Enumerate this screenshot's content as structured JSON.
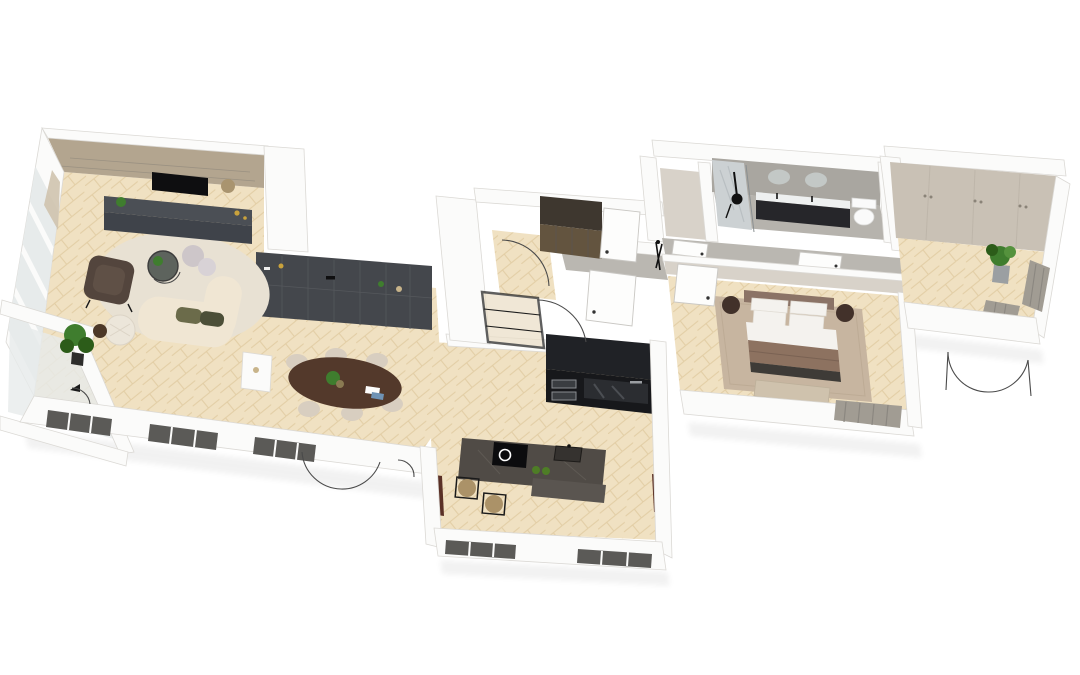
{
  "scene": {
    "title": "3D dollhouse floor plan render of an apartment, top-down angled view on white background",
    "view": "top-down 3d dollhouse",
    "door_swing_arcs_visible": 7,
    "rooms": [
      {
        "name": "living-room",
        "floor": "light herringbone wood",
        "contents": [
          "wall-mounted tv",
          "dark tv console",
          "textured beige accent wall",
          "curved cream sofa with olive cushions",
          "brown leather armchair",
          "round glass coffee table with plant",
          "round cream rug",
          "knit pouf",
          "corner floor plant",
          "tall curtained windows",
          "balcony with white railing and plant"
        ]
      },
      {
        "name": "dining-area",
        "floor": "light herringbone wood",
        "contents": [
          "dark charcoal wall shelving unit with decor",
          "oval walnut dining table",
          "six beige chairs",
          "table plant and magazines",
          "small white side shelf",
          "french doors with swing arcs"
        ]
      },
      {
        "name": "kitchen",
        "floor": "light herringbone wood",
        "contents": [
          "black tall cabinet wall with double ovens",
          "dark stone island",
          "induction cooktop",
          "island sink",
          "green apples",
          "two rattan bar stools",
          "dark window strips in bottom wall",
          "brown side panels"
        ]
      },
      {
        "name": "entry-hall",
        "floor": "light herringbone wood",
        "contents": [
          "dark wood wardrobe",
          "two white doors with handles",
          "black steel-framed glass partition",
          "door swing arc"
        ]
      },
      {
        "name": "hallway",
        "floor": "grey screed",
        "contents": [
          "white door leafs",
          "black coat rack"
        ]
      },
      {
        "name": "bathroom",
        "floor": "grey concrete",
        "contents": [
          "marble shower wall with black shower set",
          "dark double vanity with white top",
          "two round mirrors",
          "toilet",
          "adjoining small closet room"
        ]
      },
      {
        "name": "bedroom",
        "floor": "light herringbone wood",
        "contents": [
          "double bed with white pillows and taupe blanket",
          "dark throw",
          "foot bench",
          "two round dark nightstands",
          "large beige area rug",
          "white door leaf",
          "curtained bottom window"
        ]
      },
      {
        "name": "second-room",
        "floor": "light herringbone wood",
        "contents": [
          "built-in beige wardrobe wall with handles",
          "potted plant",
          "curtained right windows",
          "french doors with swing arcs"
        ]
      }
    ]
  },
  "palette": {
    "bg": "#ffffff",
    "wallTop": "#fbfbfa",
    "wallFace": "#f1f0ee",
    "wallEdge": "#dbd9d5",
    "wallBeige": "#d8d2c9",
    "accentWall": "#b3a58f",
    "woodBase": "#f0e1c2",
    "woodLine": "#e2cda4",
    "concreteWall": "#a9a6a0",
    "concreteFloor": "#b6b3ad",
    "hallFloor": "#bab7b1",
    "shelfDark": "#44474c",
    "shelfDarker": "#393c41",
    "consoleDark": "#4b4f55",
    "consoleFace": "#3f434a",
    "tvBlack": "#0e0e10",
    "kitchenTall": "#202226",
    "kitchenTallFace": "#17181b",
    "island": "#504b46",
    "islandLower": "#5a5550",
    "cooktop": "#0c0c0e",
    "sofa": "#f0e6d3",
    "rugLiving": "#e8e1d3",
    "armchair": "#53453d",
    "armchairSeat": "#5f5046",
    "pouf": "#cdc6c9",
    "knitPouf": "#ece6da",
    "tableWood": "#53392b",
    "chair": "#d8cec0",
    "bedHead": "#8b7366",
    "bedSheet": "#f4f2ee",
    "bedBlanket": "#8d7260",
    "bedThrow": "#3e3b37",
    "bedBench": "#cfc2ad",
    "rugBedroom": "#c7b5a0",
    "nightstand": "#42312a",
    "plantGreen": "#3f7d2e",
    "plantDark": "#2c5c19",
    "potGray": "#9b9fa2",
    "marble": "#ccd1d3",
    "vanityDark": "#26262a",
    "vanityTop": "#eef0f0",
    "mirror": "#c3c8c6",
    "toiletWhite": "#fafafa",
    "curtain": "#a19c93",
    "curtainBeige": "#cfc3ae",
    "maroonPanel": "#5a3026",
    "windowDark": "#5b5a57",
    "glassPane": "#e7ebeb",
    "arcStroke": "#4a4a4a",
    "doorLeaf": "#fdfdfc",
    "doorLeafStroke": "#c9c7c3",
    "handleDot": "#333333",
    "seamLine": "#55585c",
    "rattan": "#ab9268",
    "apple": "#4e7d26",
    "gold": "#c9a23c",
    "wardrobeWood": "#63543f",
    "wardrobeTop": "#3e372f",
    "closetPlane": "#c9c1b5"
  }
}
